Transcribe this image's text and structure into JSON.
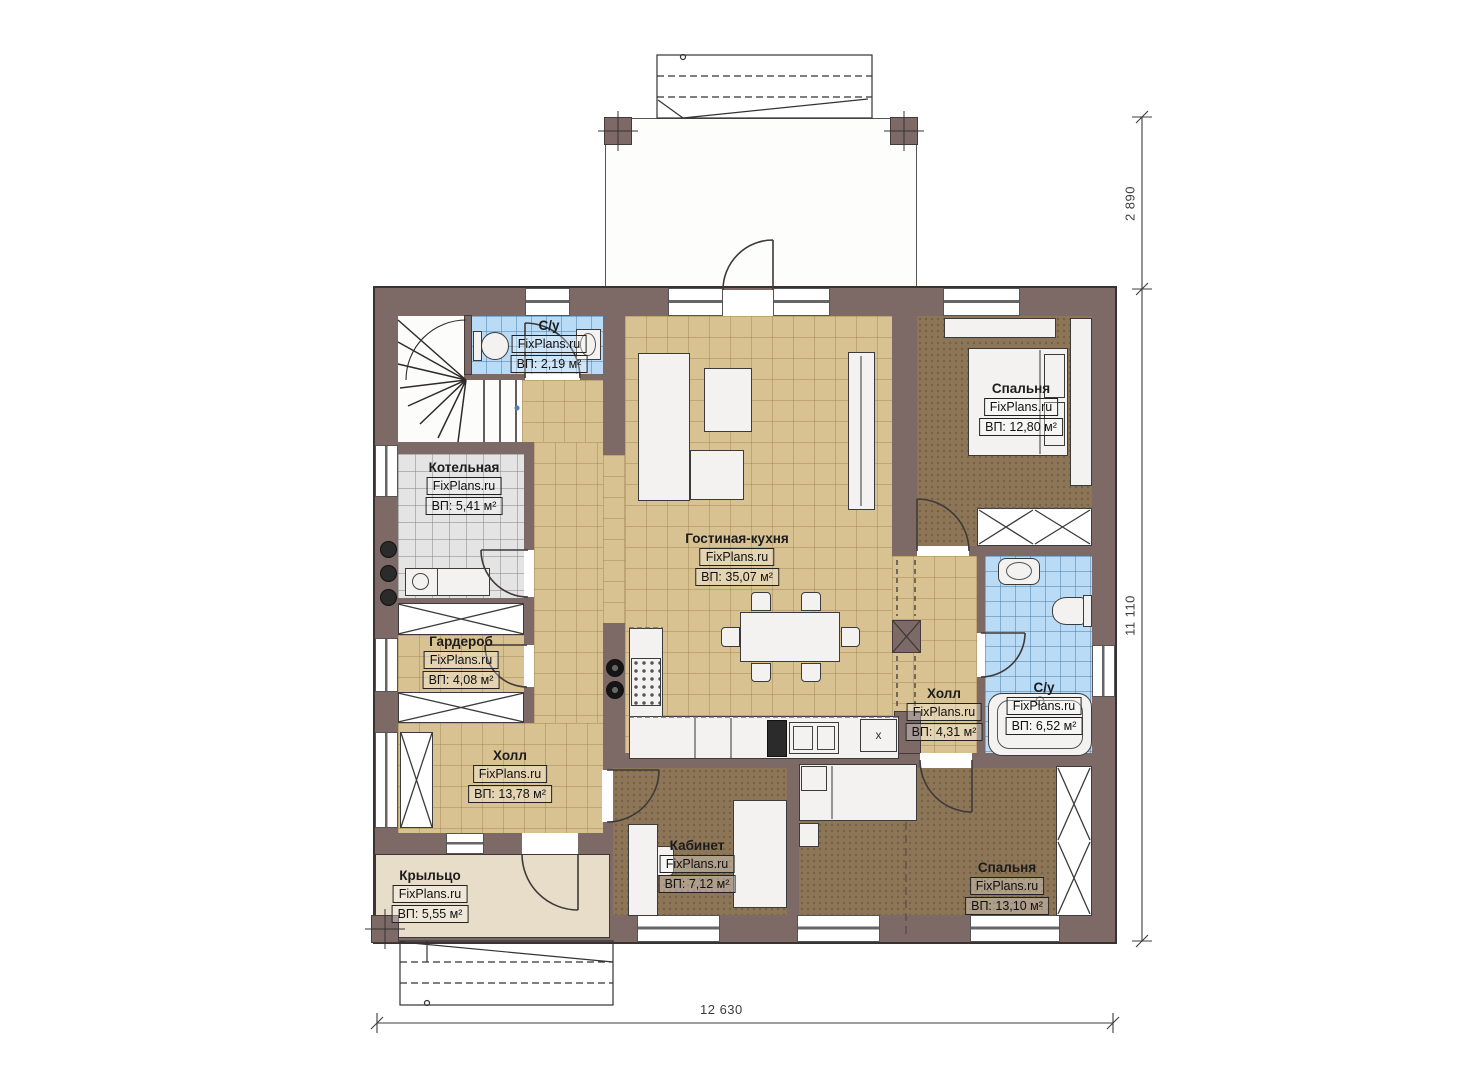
{
  "brand": "FixPlans.ru",
  "rooms": [
    {
      "name": "С/у",
      "area": "ВП: 2,19 м²"
    },
    {
      "name": "Котельная",
      "area": "ВП: 5,41 м²"
    },
    {
      "name": "Гардероб",
      "area": "ВП: 4,08 м²"
    },
    {
      "name": "Холл",
      "area": "ВП: 13,78 м²"
    },
    {
      "name": "Крыльцо",
      "area": "ВП: 5,55 м²"
    },
    {
      "name": "Гостиная-кухня",
      "area": "ВП: 35,07 м²"
    },
    {
      "name": "Спальня",
      "area": "ВП: 12,80 м²"
    },
    {
      "name": "Холл",
      "area": "ВП: 4,31 м²"
    },
    {
      "name": "С/у",
      "area": "ВП: 6,52 м²"
    },
    {
      "name": "Кабинет",
      "area": "ВП: 7,12 м²"
    },
    {
      "name": "Спальня",
      "area": "ВП: 13,10 м²"
    }
  ],
  "dimensions": {
    "upper_right": "2 890",
    "right_side": "11 110",
    "bottom": "12 630"
  },
  "kitchen": {
    "x_cabinet": "x"
  },
  "colors": {
    "wall": "#7d6a66",
    "floor_tile_tan": "#d8c291",
    "floor_wood_brown": "#8d7557",
    "floor_bath_blue": "#b9dbf5",
    "floor_boiler_gray": "#e4e4e4",
    "floor_porch": "#e8ddc8"
  }
}
